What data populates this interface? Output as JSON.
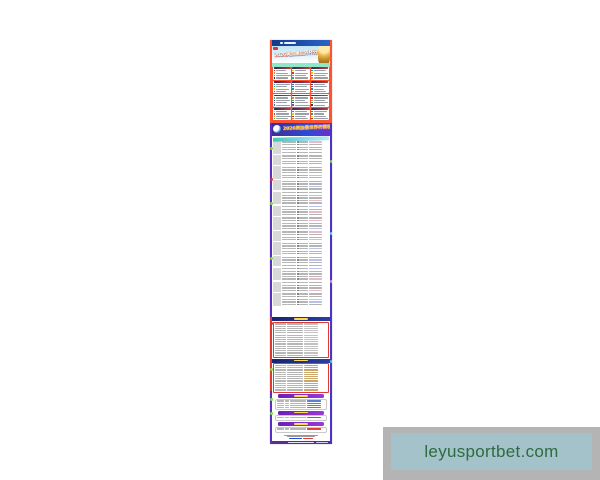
{
  "poster": {
    "title1": "2026美加墨世界杯分组",
    "title2": "2026美加墨世界杯赛程表"
  },
  "watermark": {
    "text": "leyusportbet.com",
    "outer_bg": "#b4b4b4",
    "inner_bg": "#a3c2c9",
    "text_color": "#2e6b3f"
  },
  "colors": {
    "top_section_bg": "#ff5230",
    "mint_band": "#8fe7c7",
    "header_bar": "#123a8c",
    "banner_purple": "#3f2b96",
    "banner_blue": "#2b4bd8",
    "rail_purple": "#5a2fc0",
    "knockout_border": "#e0392e",
    "highlight_tan": "#c9a56b",
    "highlight_blue": "#5b7fd4",
    "highlight_red": "#e04040",
    "footer_purple": "#5b2d91",
    "flag_palette": [
      "#c0392b",
      "#2980b9",
      "#27ae60",
      "#f1c40f",
      "#8e44ad",
      "#e67e22",
      "#16a085",
      "#2c3e50"
    ]
  },
  "structure": {
    "groups": {
      "count": 12,
      "cols": 3,
      "teams_per_group": 4
    },
    "schedule": {
      "blocks": [
        5,
        4,
        5,
        4,
        5,
        4,
        5,
        4,
        5,
        4,
        5,
        4,
        5
      ]
    },
    "knockout": [
      {
        "header": "navy",
        "rows": 16,
        "highlight": "none",
        "panel_h": 36
      },
      {
        "header": "navy",
        "rows": 13,
        "highlight": "tan",
        "panel_h": 30
      },
      {
        "header": "purple",
        "rows": 4,
        "highlight": "blue",
        "panel_h": 11
      },
      {
        "header": "purple",
        "rows": 1,
        "highlight": "red",
        "panel_h": 6
      },
      {
        "header": "purple",
        "rows": 1,
        "highlight": "red",
        "panel_h": 6
      }
    ],
    "rail_blobs": [
      {
        "side": "L",
        "y": 107,
        "color": "#6fe32e"
      },
      {
        "side": "L",
        "y": 138,
        "color": "#e03030"
      },
      {
        "side": "L",
        "y": 162,
        "color": "#6fe32e"
      },
      {
        "side": "L",
        "y": 217,
        "color": "#6fe32e"
      },
      {
        "side": "L",
        "y": 282,
        "color": "#e03030"
      },
      {
        "side": "L",
        "y": 328,
        "color": "#6fe32e"
      },
      {
        "side": "L",
        "y": 358,
        "color": "#6fe32e"
      },
      {
        "side": "L",
        "y": 372,
        "color": "#6fe32e"
      },
      {
        "side": "R",
        "y": 120,
        "color": "#6fe32e"
      },
      {
        "side": "R",
        "y": 192,
        "color": "#4fd8e8"
      },
      {
        "side": "R",
        "y": 240,
        "color": "#e88ab9"
      },
      {
        "side": "R",
        "y": 320,
        "color": "#35d8b0"
      }
    ]
  }
}
